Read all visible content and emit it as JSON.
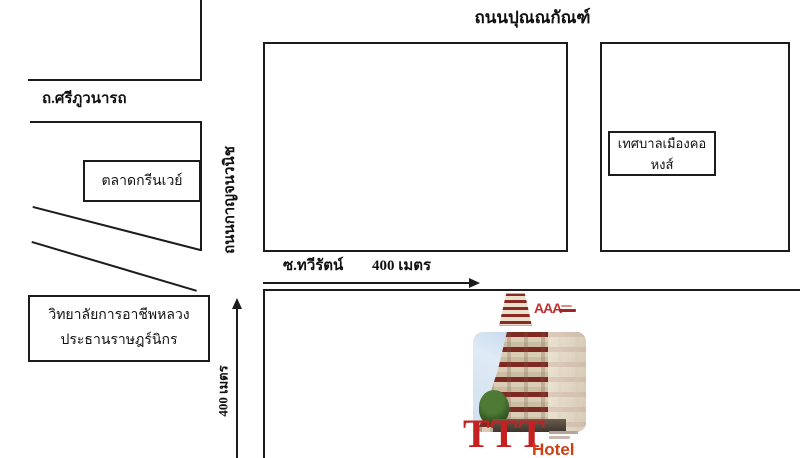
{
  "map": {
    "roads": {
      "top": "ถนนปุณณกัณฑ์",
      "left": "ถ.ศรีภูวนารถ",
      "vertical": "ถนนกาญจนวนิช",
      "soi": "ซ.ทวีรัตน์",
      "soi_distance": "400 เมตร",
      "south_distance": "400 เมตร"
    },
    "places": {
      "market": "ตลาดกรีนเวย์",
      "college_line1": "วิทยาลัยการอาชีพหลวง",
      "college_line2": "ประธานราษฎร์นิกร",
      "municipality": "เทศบาลเมืองคอหงส์"
    }
  },
  "hotel": {
    "logo_text": "AAA",
    "brand": "TTT",
    "brand_word": "Hotel"
  },
  "colors": {
    "line": "#1c1c1c",
    "brand_red": "#c42222",
    "hotel_orange": "#cf3f12",
    "background": "#ffffff"
  }
}
